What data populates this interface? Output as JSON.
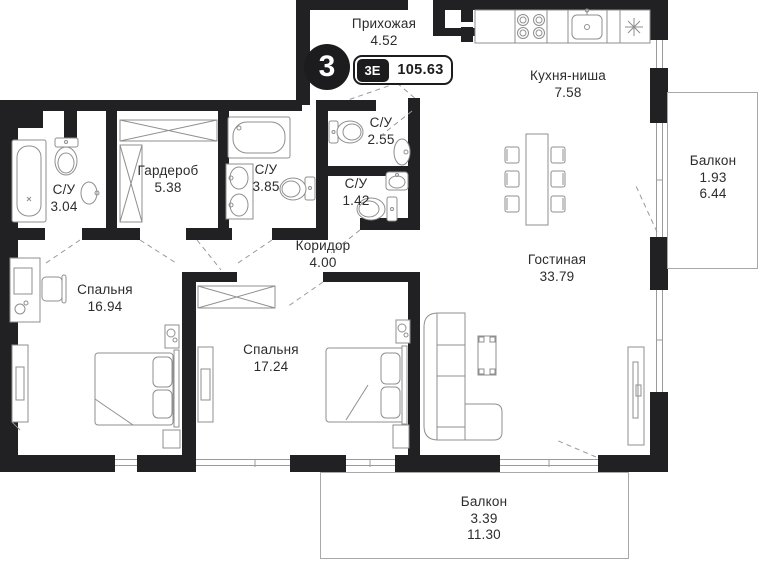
{
  "plan": {
    "badge": {
      "number": "3",
      "type": "3Е",
      "total_area": "105.63"
    },
    "rooms": {
      "hallway": {
        "name": "Прихожая",
        "area": "4.52"
      },
      "kitchen": {
        "name": "Кухня-ниша",
        "area": "7.58"
      },
      "bath304": {
        "name": "С/У",
        "area": "3.04"
      },
      "wardrobe": {
        "name": "Гардероб",
        "area": "5.38"
      },
      "bath385": {
        "name": "С/У",
        "area": "3.85"
      },
      "bath255": {
        "name": "С/У",
        "area": "2.55"
      },
      "bath142": {
        "name": "С/У",
        "area": "1.42"
      },
      "corridor": {
        "name": "Коридор",
        "area": "4.00"
      },
      "living": {
        "name": "Гостиная",
        "area": "33.79"
      },
      "bedroom1": {
        "name": "Спальня",
        "area": "16.94"
      },
      "bedroom2": {
        "name": "Спальня",
        "area": "17.24"
      },
      "balconyRight": {
        "name": "Балкон",
        "area_reduced": "1.93",
        "area_full": "6.44"
      },
      "balconyBottom": {
        "name": "Балкон",
        "area_reduced": "3.39",
        "area_full": "11.30"
      }
    },
    "colors": {
      "wall": "#212123",
      "line": "#8f8f8f",
      "text": "#2c2c2e"
    }
  }
}
